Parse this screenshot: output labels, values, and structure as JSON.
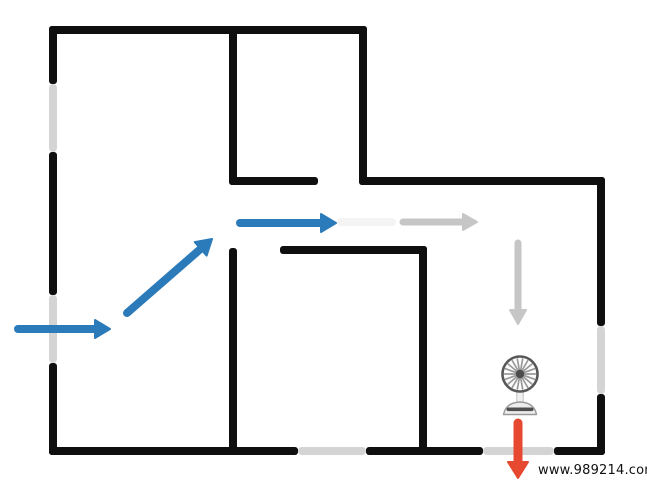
{
  "page": {
    "title": "Airflow floor plan diagram"
  },
  "canvas": {
    "width": 647,
    "height": 482
  },
  "colors": {
    "background": "#ffffff",
    "wall": "#0f0f0f",
    "window": "#d4d4d4",
    "flow_in": "#2b7ab9",
    "flow_neutral": "#c6c6c6",
    "flow_faded": "#f4f4f4",
    "flow_out": "#e6492f",
    "fan_cage": "#58585a",
    "fan_blade": "#9a9a9a",
    "fan_hub": "#4c4c4e",
    "fan_stem": "#f0f0f0",
    "fan_stem_edge": "#c2c2c2",
    "fan_base": "#ededed",
    "fan_base_edge": "#9a9a9a",
    "fan_base_stripe": "#4f4f52",
    "watermark_text": "#111111"
  },
  "walls": [
    {
      "name": "outer-wall-top",
      "x": 49,
      "y": 26,
      "w": 318,
      "h": 8
    },
    {
      "name": "outer-wall-left-upper",
      "x": 49,
      "y": 26,
      "w": 8,
      "h": 58
    },
    {
      "name": "outer-wall-left-middle",
      "x": 49,
      "y": 152,
      "w": 8,
      "h": 143
    },
    {
      "name": "outer-wall-left-lower",
      "x": 49,
      "y": 363,
      "w": 8,
      "h": 92
    },
    {
      "name": "outer-wall-step-vertical",
      "x": 359,
      "y": 26,
      "w": 8,
      "h": 159
    },
    {
      "name": "outer-wall-step-horizontal",
      "x": 359,
      "y": 177,
      "w": 246,
      "h": 8
    },
    {
      "name": "outer-wall-right-upper",
      "x": 597,
      "y": 177,
      "w": 8,
      "h": 149
    },
    {
      "name": "outer-wall-right-lower",
      "x": 597,
      "y": 394,
      "w": 8,
      "h": 61
    },
    {
      "name": "outer-wall-bottom-left",
      "x": 49,
      "y": 447,
      "w": 249,
      "h": 8
    },
    {
      "name": "outer-wall-bottom-middle",
      "x": 366,
      "y": 447,
      "w": 117,
      "h": 8
    },
    {
      "name": "outer-wall-bottom-right",
      "x": 554,
      "y": 447,
      "w": 51,
      "h": 8
    },
    {
      "name": "top-room-wall-vertical",
      "x": 229,
      "y": 26,
      "w": 8,
      "h": 159
    },
    {
      "name": "top-room-wall-horizontal",
      "x": 229,
      "y": 177,
      "w": 89,
      "h": 8
    },
    {
      "name": "center-room-wall-left",
      "x": 229,
      "y": 248,
      "w": 8,
      "h": 207
    },
    {
      "name": "center-room-wall-top",
      "x": 280,
      "y": 246,
      "w": 147,
      "h": 8
    },
    {
      "name": "center-room-wall-right",
      "x": 419,
      "y": 246,
      "w": 8,
      "h": 209
    }
  ],
  "windows": [
    {
      "name": "window-left-upper",
      "x": 49,
      "y": 84,
      "w": 8,
      "h": 68
    },
    {
      "name": "window-left-lower",
      "x": 49,
      "y": 295,
      "w": 8,
      "h": 68
    },
    {
      "name": "window-right",
      "x": 597,
      "y": 326,
      "w": 8,
      "h": 68
    },
    {
      "name": "window-bottom-center",
      "x": 298,
      "y": 447,
      "w": 68,
      "h": 8
    },
    {
      "name": "window-bottom-right",
      "x": 483,
      "y": 447,
      "w": 71,
      "h": 8
    }
  ],
  "arrows": [
    {
      "name": "airflow-arrow-inlet",
      "color": "flow_in",
      "x1": 18,
      "y1": 329,
      "x2": 110,
      "y2": 329,
      "stroke_width": 8,
      "head_len": 15,
      "head_halfwidth": 9,
      "head": true
    },
    {
      "name": "airflow-arrow-diagonal",
      "color": "flow_in",
      "x1": 127,
      "y1": 313,
      "x2": 212,
      "y2": 239,
      "stroke_width": 8,
      "head_len": 15,
      "head_halfwidth": 9,
      "head": true
    },
    {
      "name": "airflow-arrow-corridor",
      "color": "flow_in",
      "x1": 240,
      "y1": 223,
      "x2": 336,
      "y2": 223,
      "stroke_width": 8,
      "head_len": 15,
      "head_halfwidth": 9,
      "head": true
    },
    {
      "name": "airflow-trace-faded",
      "color": "flow_faded",
      "x1": 341,
      "y1": 222,
      "x2": 392,
      "y2": 222,
      "stroke_width": 8,
      "head_len": 0,
      "head_halfwidth": 0,
      "head": false
    },
    {
      "name": "airflow-arrow-hall-gray",
      "color": "flow_neutral",
      "x1": 403,
      "y1": 222,
      "x2": 477,
      "y2": 222,
      "stroke_width": 7,
      "head_len": 14,
      "head_halfwidth": 8,
      "head": true
    },
    {
      "name": "airflow-arrow-down-gray",
      "color": "flow_neutral",
      "x1": 518,
      "y1": 243,
      "x2": 518,
      "y2": 324,
      "stroke_width": 7,
      "head_len": 14,
      "head_halfwidth": 8,
      "head": true
    },
    {
      "name": "airflow-arrow-outlet",
      "color": "flow_out",
      "x1": 518,
      "y1": 423,
      "x2": 518,
      "y2": 478,
      "stroke_width": 9,
      "head_len": 16,
      "head_halfwidth": 10,
      "head": true
    }
  ],
  "fan": {
    "name": "desk-fan",
    "cx": 520,
    "cy": 374,
    "cage_radius": 17.5,
    "blade_count": 18,
    "hub_radius": 4.2
  },
  "watermark": {
    "text": "www.989214.com"
  }
}
